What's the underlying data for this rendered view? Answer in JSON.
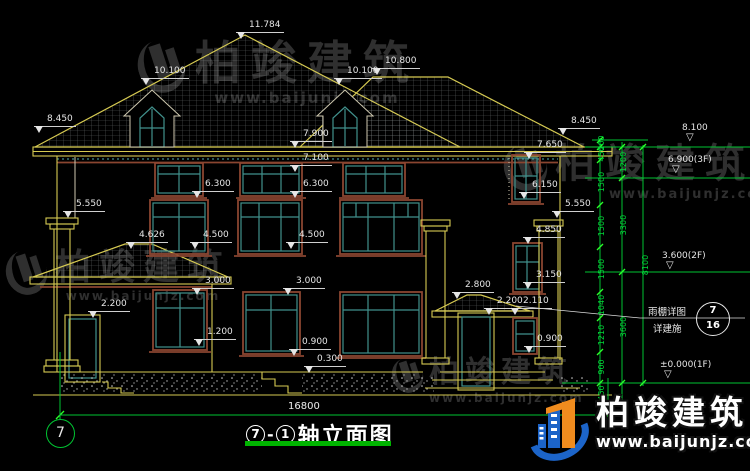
{
  "watermark": {
    "brand": "柏竣建筑",
    "url": "www.baijunjz.com"
  },
  "title": {
    "circle_left": "7",
    "separator": "-",
    "circle_right": "1",
    "text": "轴立面图"
  },
  "axis": {
    "bubble": "7",
    "overall_dim": "16800"
  },
  "callout": {
    "line1": "雨棚详图",
    "line2": "详建施",
    "detail_no": "7",
    "sheet_no": "16"
  },
  "colors": {
    "line_yellow": "#d6ca52",
    "line_green": "#00c432",
    "window_teal": "#41918c",
    "frame_brown": "#8a4530",
    "dim_white": "#e6e6e6",
    "logo_blue": "#1c64c8",
    "logo_orange": "#f08c1e"
  },
  "annotations": [
    {
      "k": "dim",
      "t": "11.784",
      "x": 236,
      "y": 21
    },
    {
      "k": "dim",
      "t": "10.100",
      "x": 141,
      "y": 67
    },
    {
      "k": "dim",
      "t": "10.100",
      "x": 334,
      "y": 67
    },
    {
      "k": "dim",
      "t": "10.800",
      "x": 372,
      "y": 57
    },
    {
      "k": "dim",
      "t": "8.450",
      "x": 34,
      "y": 115
    },
    {
      "k": "dim",
      "t": "8.450",
      "x": 558,
      "y": 117
    },
    {
      "k": "dim",
      "t": "7.900",
      "x": 290,
      "y": 130
    },
    {
      "k": "dim",
      "t": "7.100",
      "x": 290,
      "y": 154
    },
    {
      "k": "dim",
      "t": "7.650",
      "x": 524,
      "y": 141
    },
    {
      "k": "dim",
      "t": "6.300",
      "x": 192,
      "y": 180
    },
    {
      "k": "dim",
      "t": "6.300",
      "x": 290,
      "y": 180
    },
    {
      "k": "dim",
      "t": "6.150",
      "x": 519,
      "y": 181
    },
    {
      "k": "dim",
      "t": "5.550",
      "x": 63,
      "y": 200
    },
    {
      "k": "dim",
      "t": "5.550",
      "x": 552,
      "y": 200
    },
    {
      "k": "dim",
      "t": "4.626",
      "x": 126,
      "y": 231
    },
    {
      "k": "dim",
      "t": "4.500",
      "x": 190,
      "y": 231
    },
    {
      "k": "dim",
      "t": "4.500",
      "x": 286,
      "y": 231
    },
    {
      "k": "dim",
      "t": "4.850",
      "x": 523,
      "y": 226
    },
    {
      "k": "dim",
      "t": "3.150",
      "x": 523,
      "y": 271
    },
    {
      "k": "dim",
      "t": "3.000",
      "x": 192,
      "y": 277
    },
    {
      "k": "dim",
      "t": "3.000",
      "x": 283,
      "y": 277
    },
    {
      "k": "dim",
      "t": "2.800",
      "x": 452,
      "y": 281
    },
    {
      "k": "dim",
      "t": "2.200",
      "x": 88,
      "y": 300
    },
    {
      "k": "dim",
      "t": "2.200",
      "x": 484,
      "y": 297
    },
    {
      "k": "dim",
      "t": "2.110",
      "x": 510,
      "y": 297
    },
    {
      "k": "dim",
      "t": "1.200",
      "x": 194,
      "y": 328
    },
    {
      "k": "dim",
      "t": "0.900",
      "x": 289,
      "y": 338
    },
    {
      "k": "dim",
      "t": "0.900",
      "x": 524,
      "y": 335
    },
    {
      "k": "dim",
      "t": "0.300",
      "x": 304,
      "y": 355
    },
    {
      "k": "level",
      "t": "8.100",
      "x": 678,
      "y": 124
    },
    {
      "k": "level",
      "t": "6.900(3F)",
      "x": 664,
      "y": 156
    },
    {
      "k": "level",
      "t": "3.600(2F)",
      "x": 658,
      "y": 252
    },
    {
      "k": "level",
      "t": "±0.000(1F)",
      "x": 656,
      "y": 361
    },
    {
      "k": "vdim",
      "t": "200",
      "x": 602,
      "y": 143
    },
    {
      "k": "vdim",
      "t": "450",
      "x": 602,
      "y": 154
    },
    {
      "k": "vdim",
      "t": "1500",
      "x": 602,
      "y": 182
    },
    {
      "k": "vdim",
      "t": "1500",
      "x": 602,
      "y": 226
    },
    {
      "k": "vdim",
      "t": "1500",
      "x": 602,
      "y": 269
    },
    {
      "k": "vdim",
      "t": "1040",
      "x": 602,
      "y": 305
    },
    {
      "k": "vdim",
      "t": "1210",
      "x": 602,
      "y": 335
    },
    {
      "k": "vdim",
      "t": "900",
      "x": 602,
      "y": 367
    },
    {
      "k": "vdim",
      "t": "450",
      "x": 602,
      "y": 393
    },
    {
      "k": "vdim",
      "t": "1200",
      "x": 624,
      "y": 162
    },
    {
      "k": "vdim",
      "t": "3300",
      "x": 624,
      "y": 225
    },
    {
      "k": "vdim",
      "t": "3600",
      "x": 624,
      "y": 327
    },
    {
      "k": "vdim",
      "t": "8100",
      "x": 646,
      "y": 265
    },
    {
      "k": "dimtext",
      "t": "16800",
      "x": 288,
      "y": 402
    }
  ]
}
